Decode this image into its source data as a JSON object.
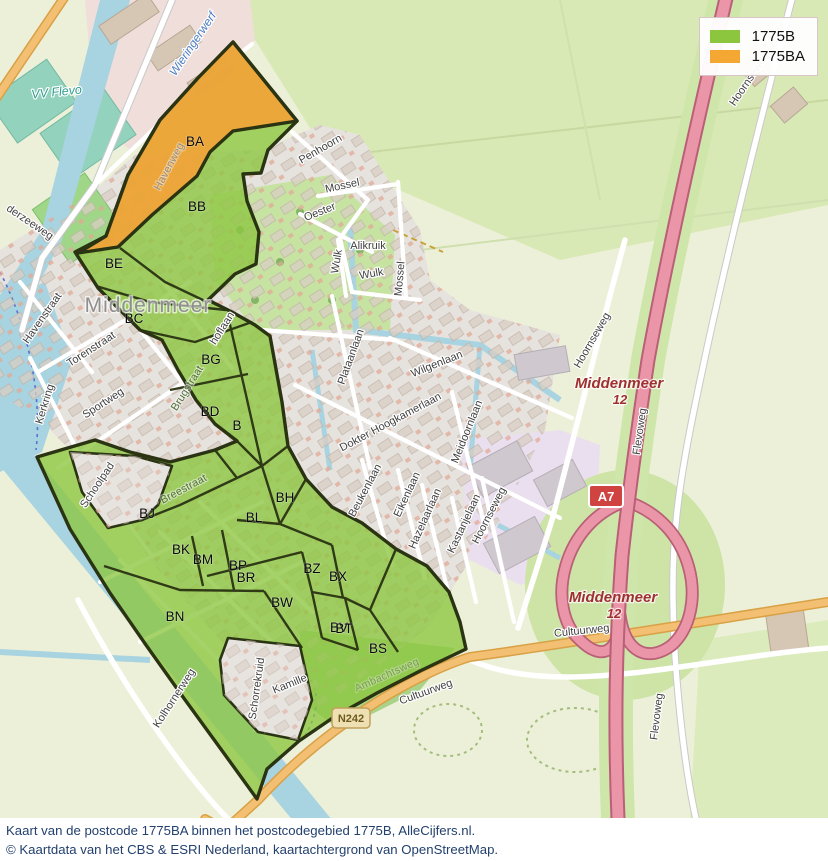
{
  "legend": {
    "items": [
      {
        "label": "1775B",
        "color": "#8CC63F"
      },
      {
        "label": "1775BA",
        "color": "#F5A733"
      }
    ]
  },
  "caption": {
    "line1": "Kaart van de postcode 1775BA binnen het postcodegebied 1775B, AlleCijfers.nl.",
    "line2": "© Kaartdata van het CBS & ESRI Nederland, kaartachtergrond van OpenStreetMap."
  },
  "place": {
    "name": "Middenmeer"
  },
  "exit": {
    "name": "Middenmeer",
    "number": "12"
  },
  "shields": {
    "motorway": "A7",
    "provincial": "N242"
  },
  "streets": [
    {
      "text": "Wieringerwerf"
    },
    {
      "text": "VV Flevo"
    },
    {
      "text": "derzeeweg"
    },
    {
      "text": "Havenstraat"
    },
    {
      "text": "Havenweg"
    },
    {
      "text": "Torenstraat"
    },
    {
      "text": "Kerkring"
    },
    {
      "text": "Sportweg"
    },
    {
      "text": "Schoolpad"
    },
    {
      "text": "Breestraat"
    },
    {
      "text": "Brugstraat"
    },
    {
      "text": "hoflaan"
    },
    {
      "text": "Penhoorn"
    },
    {
      "text": "Mossel"
    },
    {
      "text": "Oester"
    },
    {
      "text": "Wulk"
    },
    {
      "text": "Alikruik"
    },
    {
      "text": "Plataanlaan"
    },
    {
      "text": "Wilgenlaan"
    },
    {
      "text": "Dokter Hoogkamerlaan"
    },
    {
      "text": "Meidoornlaan"
    },
    {
      "text": "Beukenlaan"
    },
    {
      "text": "Eikenlaan"
    },
    {
      "text": "Hazelaarlaan"
    },
    {
      "text": "Kastanjelaan"
    },
    {
      "text": "Hoornseweg"
    },
    {
      "text": "Flevoweg"
    },
    {
      "text": "Cultuurweg"
    },
    {
      "text": "Kolhornerweg"
    },
    {
      "text": "Schorrekruid"
    },
    {
      "text": "Kamille"
    },
    {
      "text": "Ambachtsweg"
    }
  ],
  "regions": [
    {
      "code": "BA"
    },
    {
      "code": "BB"
    },
    {
      "code": "BE"
    },
    {
      "code": "BC"
    },
    {
      "code": "BG"
    },
    {
      "code": "BD"
    },
    {
      "code": "B"
    },
    {
      "code": "BH"
    },
    {
      "code": "BL"
    },
    {
      "code": "BJ"
    },
    {
      "code": "BK"
    },
    {
      "code": "BM"
    },
    {
      "code": "BP"
    },
    {
      "code": "BR"
    },
    {
      "code": "BZ"
    },
    {
      "code": "BX"
    },
    {
      "code": "BW"
    },
    {
      "code": "BN"
    },
    {
      "code": "BV"
    },
    {
      "code": "BT"
    },
    {
      "code": "BS"
    }
  ],
  "colors": {
    "overlay_green": "#8CC63F",
    "overlay_orange": "#F2A338",
    "boundary": "#2A3312",
    "water": "#A8D3E0",
    "motorway": "#EA96A8",
    "road_orange": "#F3BF72"
  }
}
